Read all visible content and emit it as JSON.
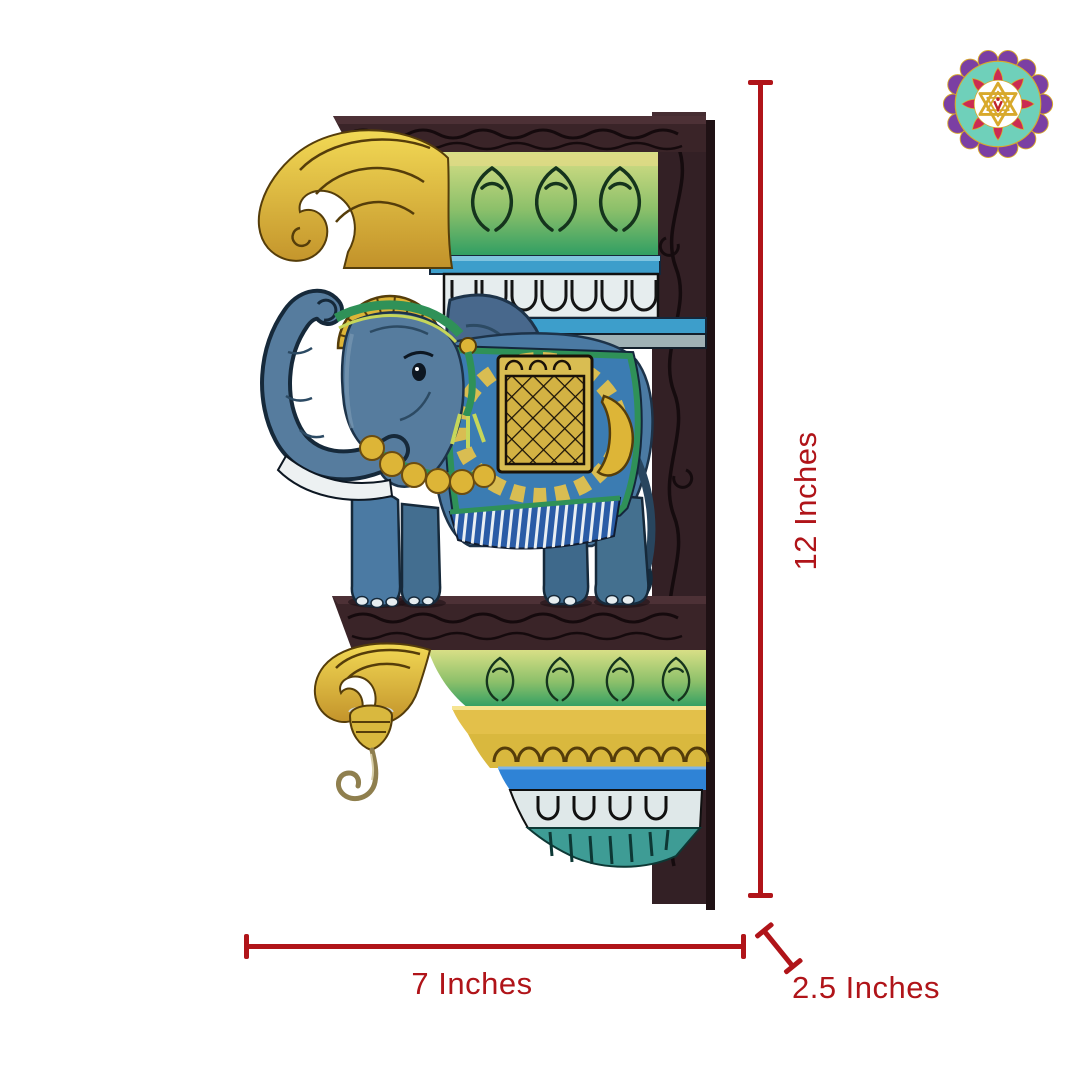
{
  "canvas": {
    "background": "#ffffff",
    "width": 1080,
    "height": 1080
  },
  "logo": {
    "name": "mandala-star-logo",
    "outer_petal_color": "#7b3fa3",
    "ring_color": "#6fd0ba",
    "petal_color": "#cb2b52",
    "star_color": "#d8a92c",
    "center_mark_color": "#c0252c"
  },
  "artwork": {
    "subject": "Hand-painted carved wooden elephant wall bracket shelf with hanging brass hook",
    "wood_color": "#332025",
    "elephant_color": "#4b7aa3",
    "accent_green": "#2f9e63",
    "accent_yellow": "#e0bf45",
    "accent_blue": "#3d9ecb",
    "accent_cream": "#e6edee"
  },
  "dimensions": {
    "annotation_color": "#b01419",
    "height": {
      "label": "12 Inches"
    },
    "width": {
      "label": "7 Inches"
    },
    "depth": {
      "label": "2.5 Inches"
    }
  }
}
